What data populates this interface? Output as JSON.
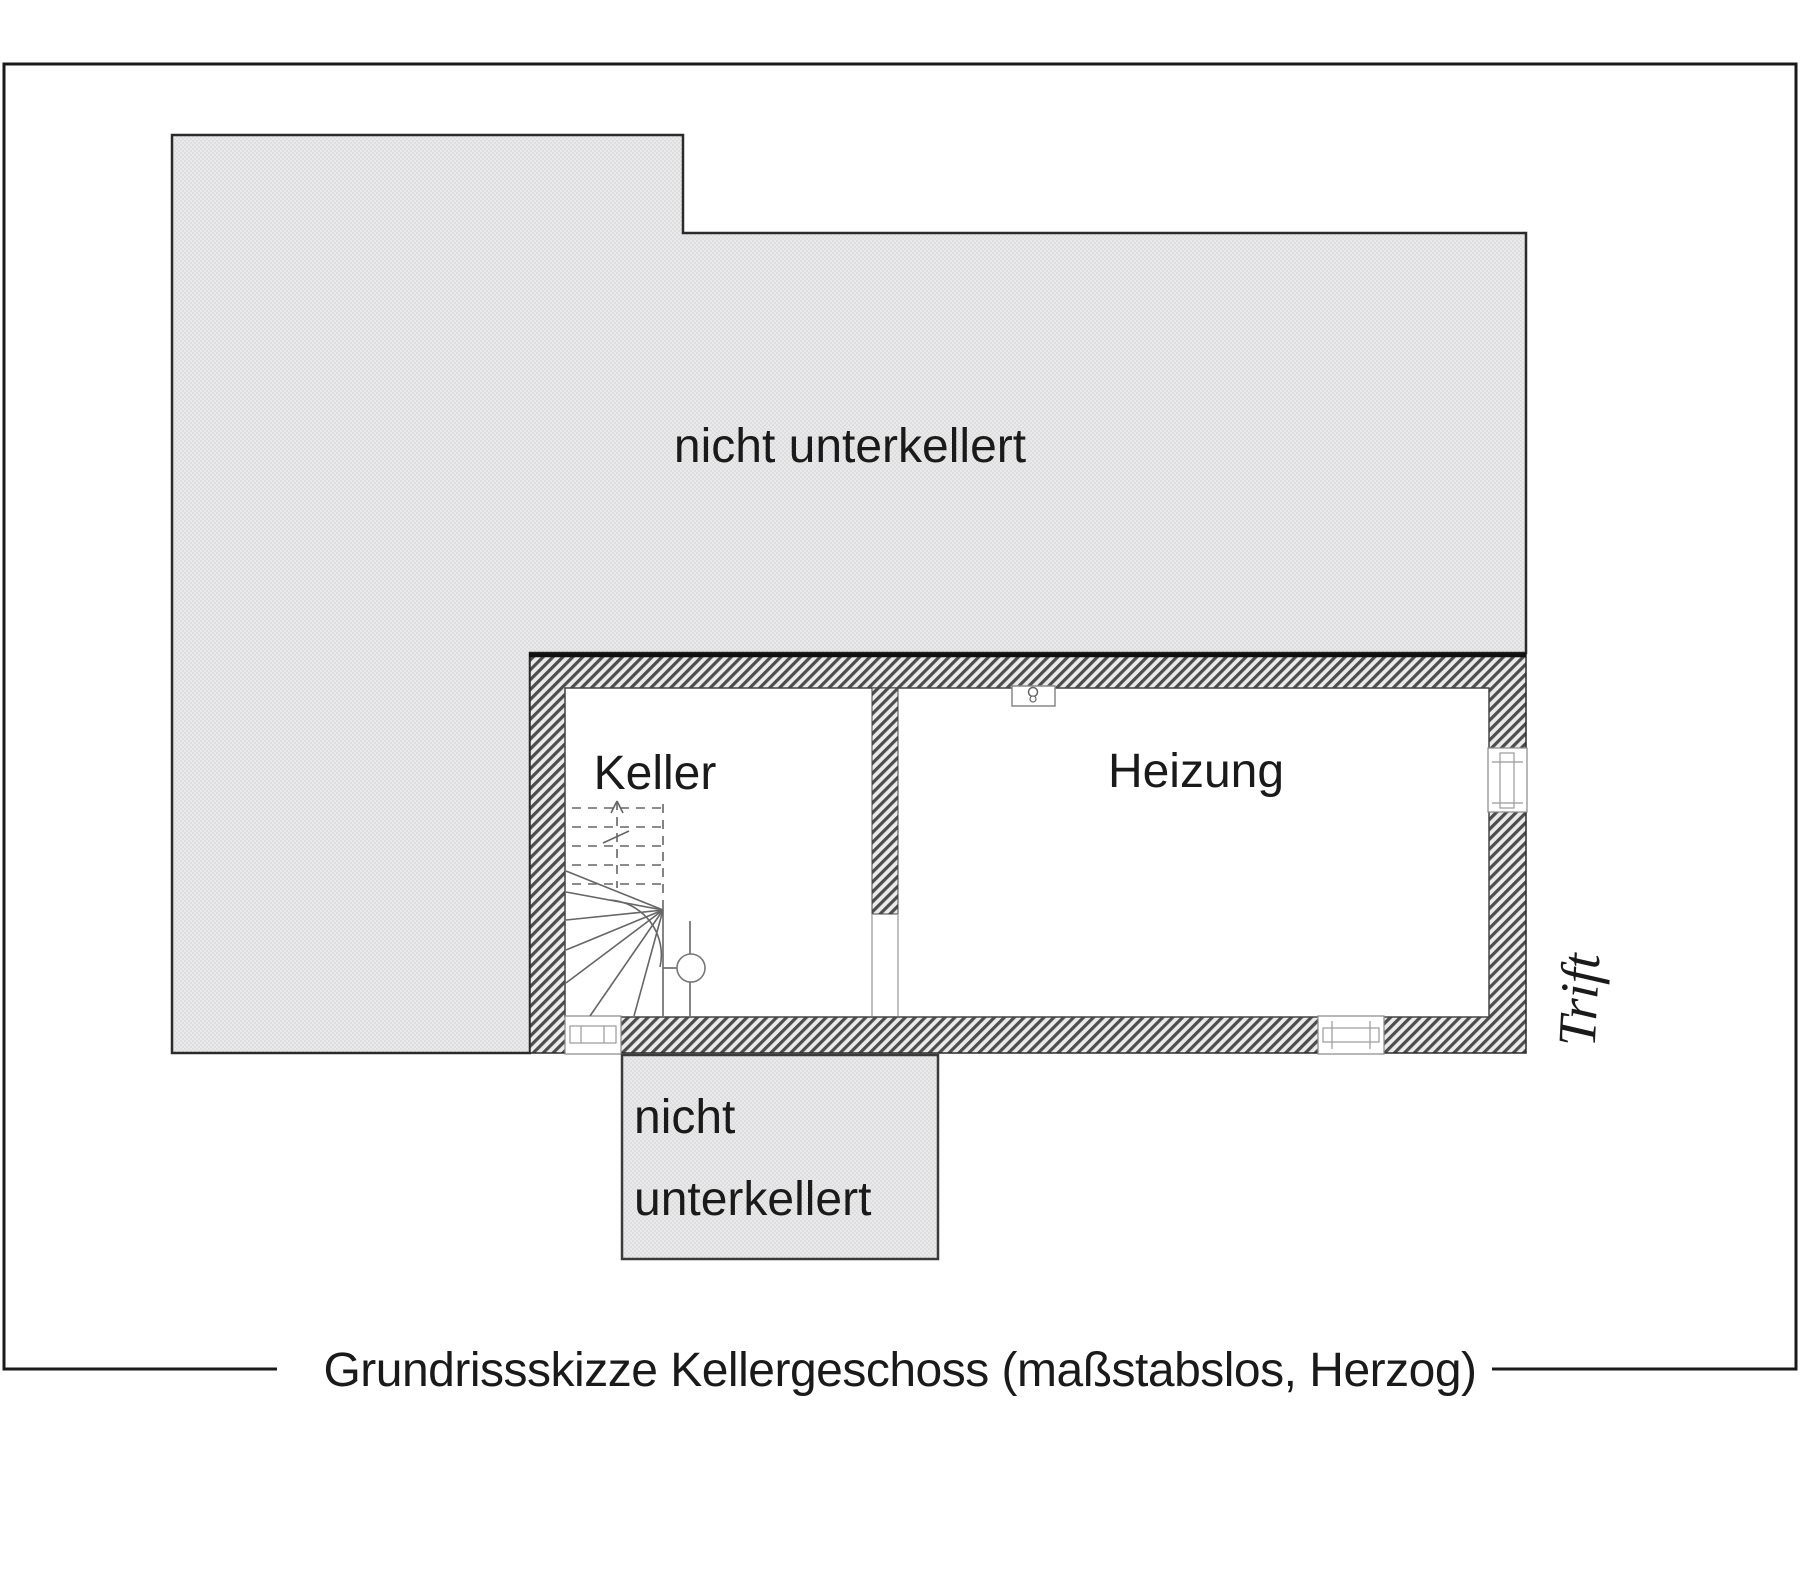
{
  "figure": {
    "caption": "Grundrissskizze Kellergeschoss (maßstabslos, Herzog)",
    "street_label": "Trift",
    "rooms": {
      "keller": "Keller",
      "heizung": "Heizung"
    },
    "areas": {
      "large_no_basement": "nicht unterkellert",
      "small_no_basement_line1": "nicht",
      "small_no_basement_line2": "unterkellert"
    },
    "icons": {
      "chimney": "chimney-symbol",
      "windows": "window-symbol",
      "stairs": "winder-stair-symbol"
    },
    "colors": {
      "area_fill": "#e9e9ea",
      "area_fill_dot": "#dedee0",
      "wall_hatch_dark": "#4d4d4d",
      "wall_hatch_light": "#ebebeb",
      "outline": "#1a1a1a",
      "thin_line": "#666666"
    }
  }
}
